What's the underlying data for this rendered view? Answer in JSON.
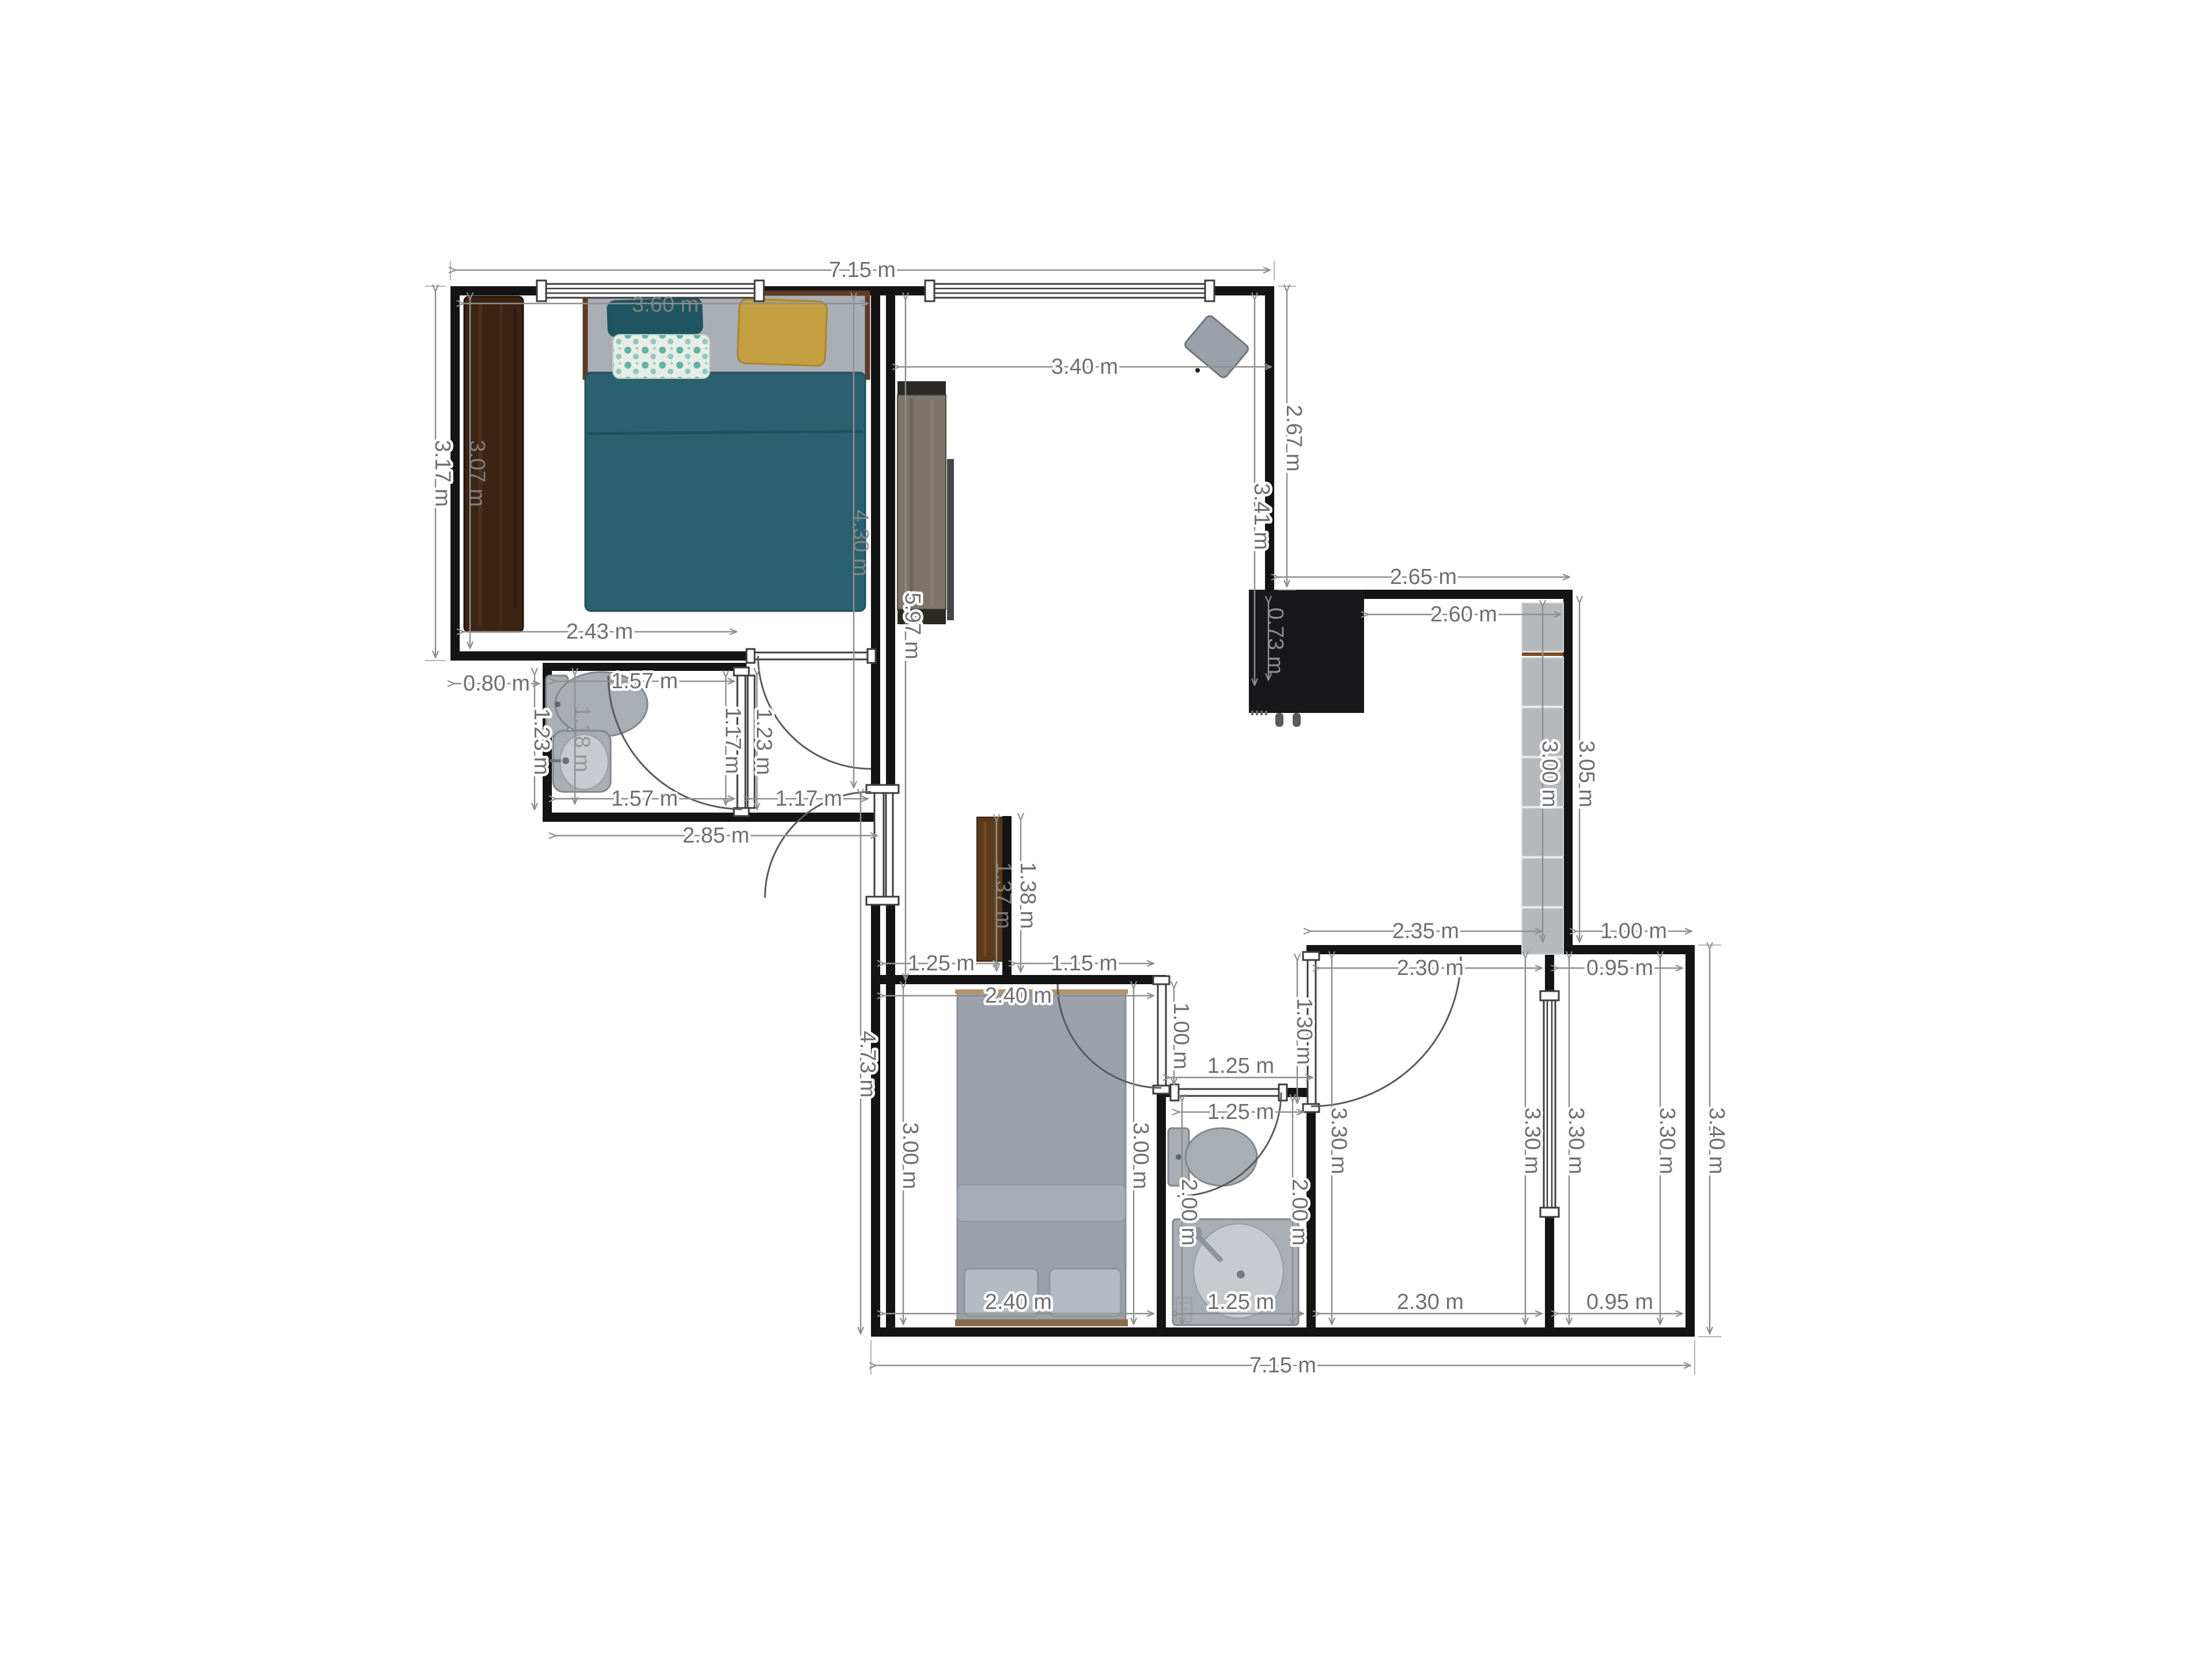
{
  "plan": {
    "type": "apartment-floor-plan",
    "units": "m",
    "dims": [
      {
        "text": "7.15 m"
      },
      {
        "text": "3.60 m"
      },
      {
        "text": "3.40 m"
      },
      {
        "text": "2.65 m"
      },
      {
        "text": "2.60 m"
      },
      {
        "text": "2.43 m"
      },
      {
        "text": "0.80 m"
      },
      {
        "text": "1.57 m"
      },
      {
        "text": "1.57 m"
      },
      {
        "text": "1.17 m"
      },
      {
        "text": "2.85 m"
      },
      {
        "text": "1.25 m"
      },
      {
        "text": "1.15 m"
      },
      {
        "text": "2.40 m"
      },
      {
        "text": "2.35 m"
      },
      {
        "text": "1.00 m"
      },
      {
        "text": "2.30 m"
      },
      {
        "text": "0.95 m"
      },
      {
        "text": "1.25 m"
      },
      {
        "text": "1.25 m"
      },
      {
        "text": "2.40 m"
      },
      {
        "text": "1.25 m"
      },
      {
        "text": "2.30 m"
      },
      {
        "text": "0.95 m"
      },
      {
        "text": "7.15 m"
      },
      {
        "text": "3.17 m"
      },
      {
        "text": "3.07 m"
      },
      {
        "text": "4.30 m"
      },
      {
        "text": "5.97 m"
      },
      {
        "text": "2.67 m"
      },
      {
        "text": "3.41 m"
      },
      {
        "text": "0.73 m"
      },
      {
        "text": "3.00 m"
      },
      {
        "text": "3.05 m"
      },
      {
        "text": "1.23 m"
      },
      {
        "text": "1.18 m"
      },
      {
        "text": "1.17 m"
      },
      {
        "text": "1.23 m"
      },
      {
        "text": "1.37 m"
      },
      {
        "text": "1.38 m"
      },
      {
        "text": "4.73 m"
      },
      {
        "text": "3.00 m"
      },
      {
        "text": "3.00 m"
      },
      {
        "text": "1.00 m"
      },
      {
        "text": "2.00 m"
      },
      {
        "text": "2.00 m"
      },
      {
        "text": "1.30 m"
      },
      {
        "text": "3.30 m"
      },
      {
        "text": "3.30 m"
      },
      {
        "text": "3.30 m"
      },
      {
        "text": "3.30 m"
      },
      {
        "text": "3.40 m"
      }
    ],
    "palette": {
      "wall": "#141414",
      "dimension": "#6f6f6f",
      "bed_teal": "#2b606e",
      "pillow_teal": "#1f5560",
      "pillow_yellow": "#c49f42",
      "wardrobe_wood": "#3b2414",
      "unit_wood": "#7e756a",
      "appliance_black": "#18181b",
      "cabinet_gray": "#b6b9bc",
      "hall_cabinet_wood": "#5b3a1d",
      "fixture_gray": "#a9aeb4",
      "bed2_gray": "#9aa1aa"
    }
  }
}
